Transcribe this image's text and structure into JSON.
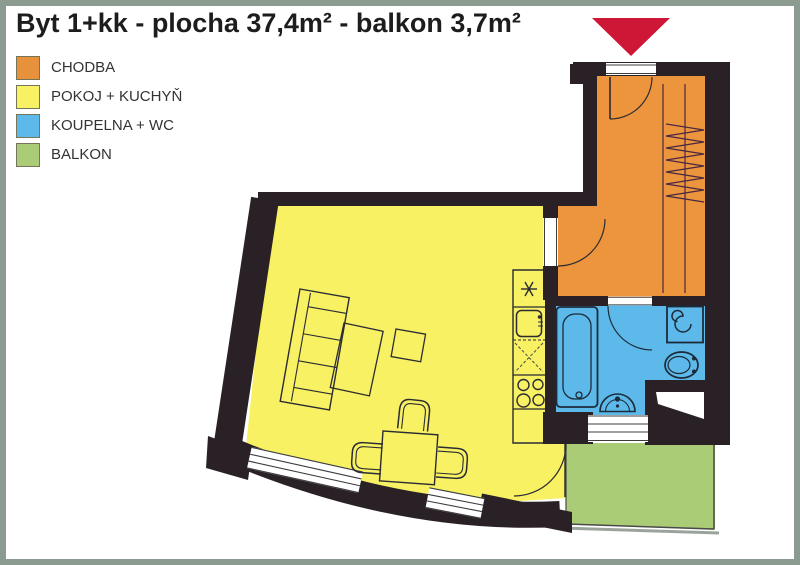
{
  "title": "Byt 1+kk - plocha 37,4m² - balkon 3,7m²",
  "legend": {
    "items": [
      {
        "label": "CHODBA",
        "color": "#e8913d"
      },
      {
        "label": "POKOJ + KUCHYŇ",
        "color": "#f7f163"
      },
      {
        "label": "KOUPELNA + WC",
        "color": "#5db9e9"
      },
      {
        "label": "BALKON",
        "color": "#abcc77"
      }
    ]
  },
  "floorplan": {
    "rooms": {
      "chodba": {
        "label": "CHODBA"
      },
      "pokoj": {
        "label": "POKOJ + KUCHYŇ"
      },
      "koupelna": {
        "label": "KOUPELNA + WC"
      },
      "balkon": {
        "label": "BALKON"
      }
    },
    "colors": {
      "hall": "#ec953d",
      "room": "#f7f163",
      "bath": "#5db9e9",
      "balcony": "#abcc77",
      "wall": "#2a2127",
      "arrow": "#ce1637",
      "frame": "#8b9b90",
      "hanger": "#4a2742"
    }
  }
}
